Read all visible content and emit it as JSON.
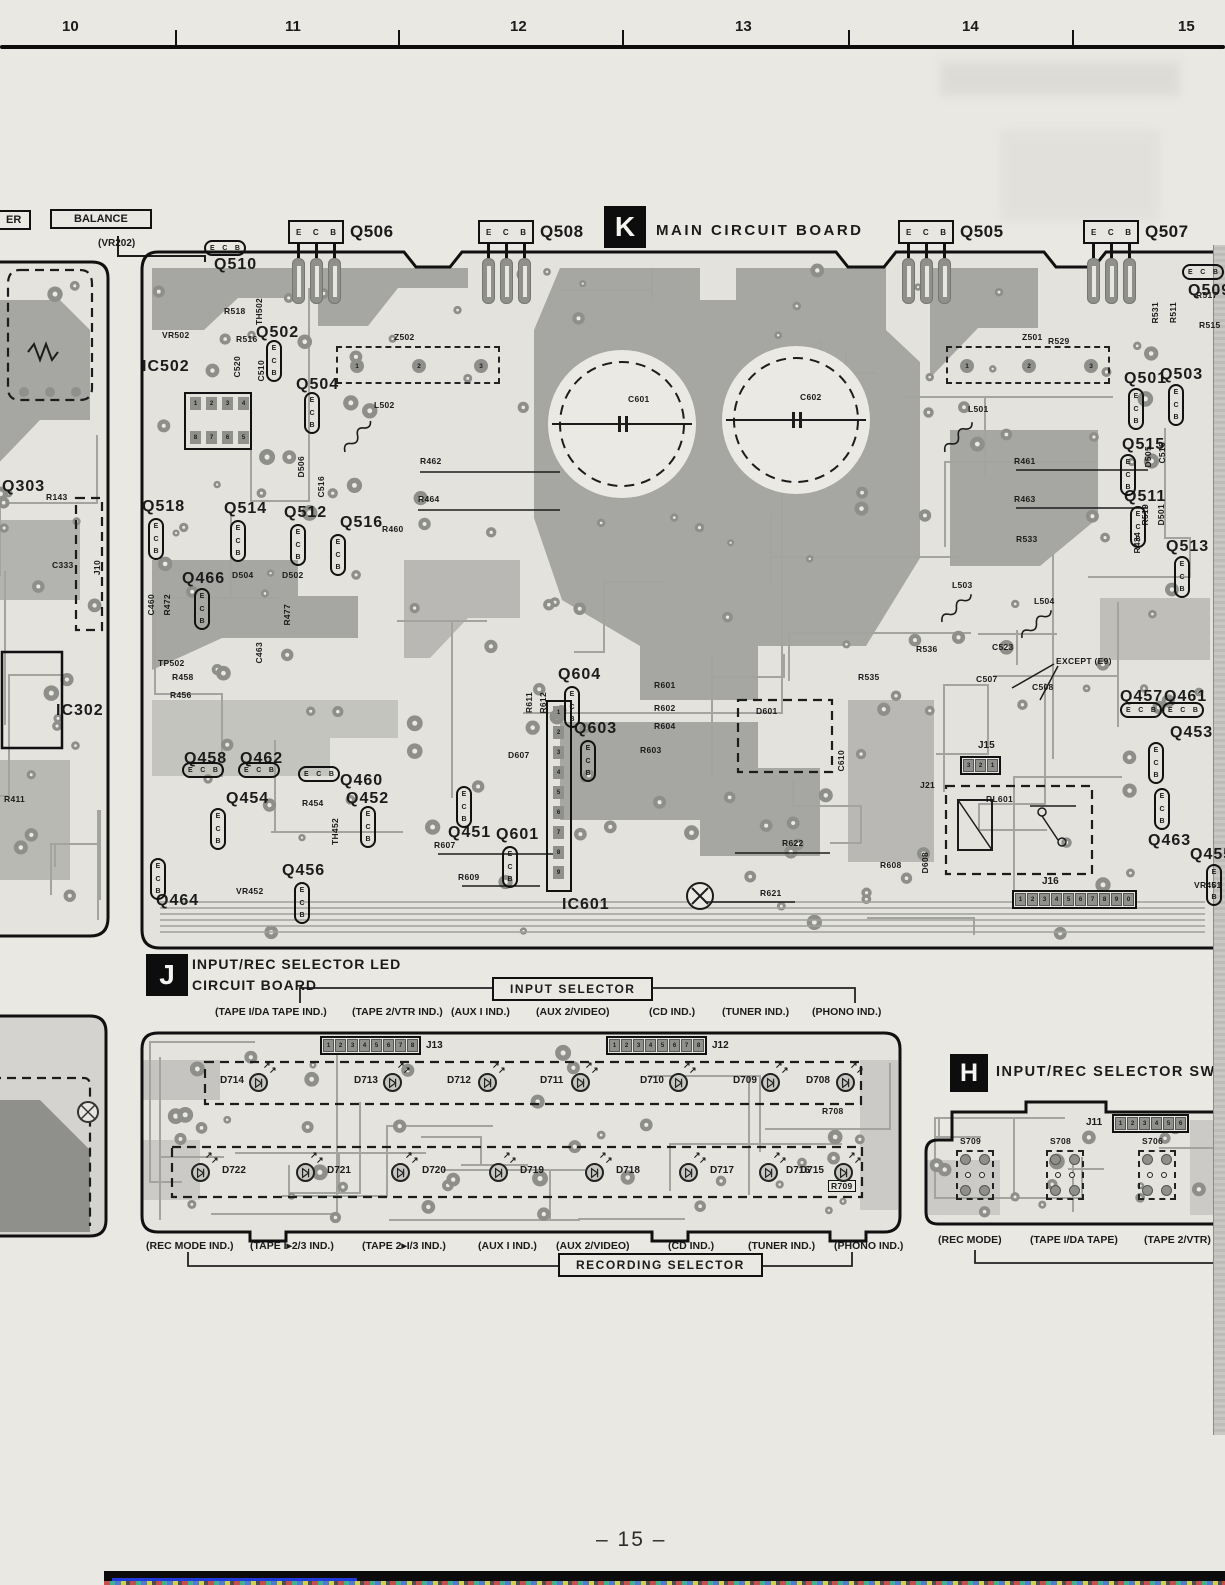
{
  "ruler": {
    "numbers": [
      "10",
      "11",
      "12",
      "13",
      "14",
      "15"
    ]
  },
  "page_number": "– 15 –",
  "ecb_pins": [
    "E",
    "C",
    "B"
  ],
  "colors": {
    "paper": "#e9e8e3",
    "pour": "#a6a6a2",
    "pad": "#8f8f8b",
    "ink": "#111111",
    "bottom_rule_blue": "#1f3bdd"
  },
  "left_margin": {
    "er_label": "ER",
    "balance_label": "BALANCE",
    "vr202_label": "(VR202)",
    "labels": [
      {
        "t": "Q303",
        "x": 2,
        "y": 478,
        "s": 1
      },
      {
        "t": "R143",
        "x": 46,
        "y": 492
      },
      {
        "t": "C333",
        "x": 52,
        "y": 560
      },
      {
        "t": "IC302",
        "x": 56,
        "y": 702,
        "s": 1
      },
      {
        "t": "R411",
        "x": 4,
        "y": 794
      },
      {
        "t": "J10",
        "x": 92,
        "y": 560,
        "r": 1
      }
    ]
  },
  "board_k": {
    "badge": "K",
    "title": "MAIN CIRCUIT BOARD",
    "transistor_headers": [
      {
        "label": "Q506",
        "x": 288
      },
      {
        "label": "Q508",
        "x": 478
      },
      {
        "label": "Q505",
        "x": 898
      },
      {
        "label": "Q507",
        "x": 1083
      }
    ],
    "ic502": {
      "label": "IC502",
      "pins_top": "1234",
      "pins_bottom": "8765"
    },
    "ic601": {
      "label": "IC601",
      "pins": "123456789"
    },
    "z_pins": "123",
    "connectors": [
      {
        "label": "J15",
        "pins": "321",
        "x": 960,
        "y": 756,
        "lx": 978,
        "ly": 740
      },
      {
        "label": "J16",
        "pins": "1234567890",
        "x": 1012,
        "y": 890,
        "lx": 1042,
        "ly": 876
      }
    ],
    "labels": [
      {
        "t": "Q510",
        "x": 214,
        "y": 256,
        "s": 1
      },
      {
        "t": "Q502",
        "x": 256,
        "y": 324,
        "s": 1
      },
      {
        "t": "Q504",
        "x": 296,
        "y": 376,
        "s": 1
      },
      {
        "t": "IC502",
        "x": 142,
        "y": 358,
        "s": 1
      },
      {
        "t": "Q518",
        "x": 142,
        "y": 498,
        "s": 1
      },
      {
        "t": "Q514",
        "x": 224,
        "y": 500,
        "s": 1
      },
      {
        "t": "Q512",
        "x": 284,
        "y": 504,
        "s": 1
      },
      {
        "t": "Q516",
        "x": 340,
        "y": 514,
        "s": 1
      },
      {
        "t": "Q466",
        "x": 182,
        "y": 570,
        "s": 1
      },
      {
        "t": "Q604",
        "x": 558,
        "y": 666,
        "s": 1
      },
      {
        "t": "Q603",
        "x": 574,
        "y": 720,
        "s": 1
      },
      {
        "t": "Q601",
        "x": 496,
        "y": 826,
        "s": 1
      },
      {
        "t": "IC601",
        "x": 562,
        "y": 896,
        "s": 1
      },
      {
        "t": "Q458",
        "x": 184,
        "y": 750,
        "s": 1
      },
      {
        "t": "Q462",
        "x": 240,
        "y": 750,
        "s": 1
      },
      {
        "t": "Q460",
        "x": 340,
        "y": 772,
        "s": 1
      },
      {
        "t": "Q454",
        "x": 226,
        "y": 790,
        "s": 1
      },
      {
        "t": "Q452",
        "x": 346,
        "y": 790,
        "s": 1
      },
      {
        "t": "Q451",
        "x": 448,
        "y": 824,
        "s": 1
      },
      {
        "t": "Q456",
        "x": 282,
        "y": 862,
        "s": 1
      },
      {
        "t": "Q464",
        "x": 156,
        "y": 892,
        "s": 1
      },
      {
        "t": "Q501",
        "x": 1124,
        "y": 370,
        "s": 1
      },
      {
        "t": "Q503",
        "x": 1160,
        "y": 366,
        "s": 1
      },
      {
        "t": "Q515",
        "x": 1122,
        "y": 436,
        "s": 1
      },
      {
        "t": "Q511",
        "x": 1124,
        "y": 488,
        "s": 1
      },
      {
        "t": "Q513",
        "x": 1166,
        "y": 538,
        "s": 1
      },
      {
        "t": "Q457",
        "x": 1120,
        "y": 688,
        "s": 1
      },
      {
        "t": "Q461",
        "x": 1164,
        "y": 688,
        "s": 1
      },
      {
        "t": "Q453",
        "x": 1170,
        "y": 724,
        "s": 1
      },
      {
        "t": "Q463",
        "x": 1148,
        "y": 832,
        "s": 1
      },
      {
        "t": "Q455",
        "x": 1190,
        "y": 846,
        "s": 1
      },
      {
        "t": "Q509",
        "x": 1188,
        "y": 282,
        "s": 1
      },
      {
        "t": "RL601",
        "x": 986,
        "y": 794
      },
      {
        "t": "C601",
        "x": 628,
        "y": 394
      },
      {
        "t": "C602",
        "x": 800,
        "y": 392
      },
      {
        "t": "R518",
        "x": 224,
        "y": 306
      },
      {
        "t": "TH502",
        "x": 254,
        "y": 298,
        "r": 1
      },
      {
        "t": "VR502",
        "x": 162,
        "y": 330
      },
      {
        "t": "R516",
        "x": 236,
        "y": 334
      },
      {
        "t": "C520",
        "x": 232,
        "y": 356,
        "r": 1
      },
      {
        "t": "C510",
        "x": 256,
        "y": 360,
        "r": 1
      },
      {
        "t": "Z502",
        "x": 394,
        "y": 332
      },
      {
        "t": "L502",
        "x": 374,
        "y": 400
      },
      {
        "t": "R462",
        "x": 420,
        "y": 456
      },
      {
        "t": "R464",
        "x": 418,
        "y": 494
      },
      {
        "t": "D506",
        "x": 296,
        "y": 456,
        "r": 1
      },
      {
        "t": "C516",
        "x": 316,
        "y": 476,
        "r": 1
      },
      {
        "t": "R460",
        "x": 382,
        "y": 524
      },
      {
        "t": "D504",
        "x": 232,
        "y": 570
      },
      {
        "t": "D502",
        "x": 282,
        "y": 570
      },
      {
        "t": "TP502",
        "x": 158,
        "y": 658
      },
      {
        "t": "R458",
        "x": 172,
        "y": 672
      },
      {
        "t": "R456",
        "x": 170,
        "y": 690
      },
      {
        "t": "C460",
        "x": 146,
        "y": 594,
        "r": 1
      },
      {
        "t": "R472",
        "x": 162,
        "y": 594,
        "r": 1
      },
      {
        "t": "R477",
        "x": 282,
        "y": 604,
        "r": 1
      },
      {
        "t": "C463",
        "x": 254,
        "y": 642,
        "r": 1
      },
      {
        "t": "R611",
        "x": 524,
        "y": 692,
        "r": 1
      },
      {
        "t": "R612",
        "x": 538,
        "y": 692,
        "r": 1
      },
      {
        "t": "R601",
        "x": 654,
        "y": 680
      },
      {
        "t": "R602",
        "x": 654,
        "y": 703
      },
      {
        "t": "R604",
        "x": 654,
        "y": 721
      },
      {
        "t": "R603",
        "x": 640,
        "y": 745
      },
      {
        "t": "D607",
        "x": 508,
        "y": 750
      },
      {
        "t": "D601",
        "x": 756,
        "y": 706
      },
      {
        "t": "C610",
        "x": 836,
        "y": 750,
        "r": 1
      },
      {
        "t": "R622",
        "x": 782,
        "y": 838
      },
      {
        "t": "R621",
        "x": 760,
        "y": 888
      },
      {
        "t": "R607",
        "x": 434,
        "y": 840
      },
      {
        "t": "R609",
        "x": 458,
        "y": 872
      },
      {
        "t": "R454",
        "x": 302,
        "y": 798
      },
      {
        "t": "VR452",
        "x": 236,
        "y": 886
      },
      {
        "t": "TH452",
        "x": 330,
        "y": 818,
        "r": 1
      },
      {
        "t": "R529",
        "x": 1048,
        "y": 336
      },
      {
        "t": "Z501",
        "x": 1022,
        "y": 332
      },
      {
        "t": "L501",
        "x": 968,
        "y": 404
      },
      {
        "t": "R461",
        "x": 1014,
        "y": 456
      },
      {
        "t": "R463",
        "x": 1014,
        "y": 494
      },
      {
        "t": "R533",
        "x": 1016,
        "y": 534
      },
      {
        "t": "L503",
        "x": 952,
        "y": 580
      },
      {
        "t": "L504",
        "x": 1034,
        "y": 596
      },
      {
        "t": "R535",
        "x": 858,
        "y": 672
      },
      {
        "t": "R536",
        "x": 916,
        "y": 644
      },
      {
        "t": "C523",
        "x": 992,
        "y": 642
      },
      {
        "t": "C507",
        "x": 976,
        "y": 674
      },
      {
        "t": "C508",
        "x": 1032,
        "y": 682
      },
      {
        "t": "EXCEPT (E9)",
        "x": 1056,
        "y": 656
      },
      {
        "t": "J21",
        "x": 920,
        "y": 780
      },
      {
        "t": "D608",
        "x": 920,
        "y": 852,
        "r": 1
      },
      {
        "t": "R608",
        "x": 880,
        "y": 860
      },
      {
        "t": "R531",
        "x": 1150,
        "y": 302,
        "r": 1
      },
      {
        "t": "R511",
        "x": 1168,
        "y": 302,
        "r": 1
      },
      {
        "t": "R517",
        "x": 1196,
        "y": 290
      },
      {
        "t": "R515",
        "x": 1199,
        "y": 320
      },
      {
        "t": "C515",
        "x": 1157,
        "y": 442,
        "r": 1
      },
      {
        "t": "D505",
        "x": 1143,
        "y": 446,
        "r": 1
      },
      {
        "t": "R519",
        "x": 1140,
        "y": 504,
        "r": 1
      },
      {
        "t": "D501",
        "x": 1156,
        "y": 504,
        "r": 1
      },
      {
        "t": "R434",
        "x": 1132,
        "y": 532,
        "r": 1
      },
      {
        "t": "VR451",
        "x": 1194,
        "y": 880
      }
    ]
  },
  "board_j": {
    "badge": "J",
    "title_line1": "INPUT/REC SELECTOR LED",
    "title_line2": "CIRCUIT BOARD",
    "input_selector": "INPUT SELECTOR",
    "recording_selector": "RECORDING SELECTOR",
    "connectors": [
      {
        "label": "J13",
        "pins": "12345678",
        "x": 320,
        "y": 1036,
        "lx": 426,
        "ly": 1040
      },
      {
        "label": "J12",
        "pins": "12345678",
        "x": 606,
        "y": 1036,
        "lx": 712,
        "ly": 1040
      }
    ],
    "top_captions": [
      {
        "t": "(TAPE I/DA TAPE IND.)",
        "x": 215
      },
      {
        "t": "(TAPE 2/VTR IND.)",
        "x": 352
      },
      {
        "t": "(AUX I IND.)",
        "x": 451
      },
      {
        "t": "(AUX 2/VIDEO)",
        "x": 536
      },
      {
        "t": "(CD IND.)",
        "x": 649
      },
      {
        "t": "(TUNER IND.)",
        "x": 722
      },
      {
        "t": "(PHONO IND.)",
        "x": 812
      }
    ],
    "bottom_captions": [
      {
        "t": "(REC MODE IND.)",
        "x": 146
      },
      {
        "t": "(TAPE I▸2/3 IND.)",
        "x": 250
      },
      {
        "t": "(TAPE 2▸I/3 IND.)",
        "x": 362
      },
      {
        "t": "(AUX I IND.)",
        "x": 478
      },
      {
        "t": "(AUX 2/VIDEO)",
        "x": 556
      },
      {
        "t": "(CD IND.)",
        "x": 668
      },
      {
        "t": "(TUNER IND.)",
        "x": 748
      },
      {
        "t": "(PHONO IND.)",
        "x": 834
      }
    ],
    "top_leds": [
      {
        "label": "D714",
        "sym": 258,
        "lx": 220
      },
      {
        "label": "D713",
        "sym": 392,
        "lx": 354
      },
      {
        "label": "D712",
        "sym": 487,
        "lx": 447
      },
      {
        "label": "D711",
        "sym": 580,
        "lx": 540
      },
      {
        "label": "D710",
        "sym": 678,
        "lx": 640
      },
      {
        "label": "D709",
        "sym": 770,
        "lx": 733
      },
      {
        "label": "D708",
        "sym": 845,
        "lx": 806
      }
    ],
    "bottom_leds": [
      {
        "label": "D722",
        "sym": 200,
        "lx": 222
      },
      {
        "label": "D721",
        "sym": 305,
        "lx": 327
      },
      {
        "label": "D720",
        "sym": 400,
        "lx": 422
      },
      {
        "label": "D719",
        "sym": 498,
        "lx": 520
      },
      {
        "label": "D718",
        "sym": 594,
        "lx": 616
      },
      {
        "label": "D717",
        "sym": 688,
        "lx": 710
      },
      {
        "label": "D716",
        "sym": 768,
        "lx": 786
      },
      {
        "label": "D715",
        "sym": 843,
        "lx": 800
      }
    ],
    "labels": [
      {
        "t": "R708",
        "x": 822,
        "y": 1106
      },
      {
        "t": "R709",
        "x": 828,
        "y": 1180,
        "box": 1
      }
    ]
  },
  "board_h": {
    "badge": "H",
    "title": "INPUT/REC SELECTOR SWITCH",
    "connector": {
      "label": "J11",
      "pins": "123456",
      "x": 1112,
      "y": 1114,
      "lx": 1086,
      "ly": 1117
    },
    "switches": [
      {
        "label": "S709",
        "x": 956
      },
      {
        "label": "S708",
        "x": 1046
      },
      {
        "label": "S706",
        "x": 1138
      }
    ],
    "captions": [
      {
        "t": "(REC MODE)",
        "x": 938
      },
      {
        "t": "(TAPE I/DA TAPE)",
        "x": 1030
      },
      {
        "t": "(TAPE 2/VTR)",
        "x": 1144
      }
    ]
  }
}
